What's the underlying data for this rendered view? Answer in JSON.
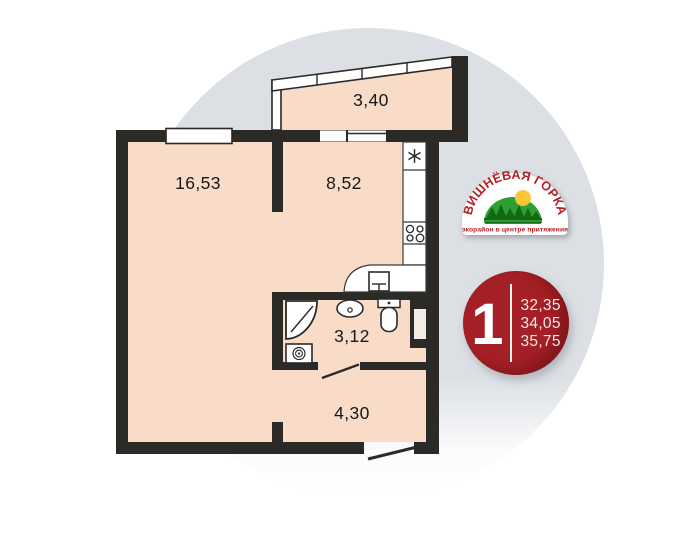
{
  "plan": {
    "rooms": [
      {
        "name": "balcony",
        "area": "3,40"
      },
      {
        "name": "living-room",
        "area": "16,53"
      },
      {
        "name": "kitchen",
        "area": "8,52"
      },
      {
        "name": "bathroom",
        "area": "3,12"
      },
      {
        "name": "hallway",
        "area": "4,30"
      }
    ],
    "fixtures": [
      "fridge-icon",
      "stove-icon",
      "kitchen-sink-icon",
      "shower-icon",
      "washing-machine-icon",
      "bathroom-sink-icon",
      "toilet-icon",
      "vent-shaft",
      "bathroom-door-swing",
      "entrance-door-swing"
    ]
  },
  "logo": {
    "title": "ВИШНЁВАЯ ГОРКА",
    "tagline": "экорайон в центре притяжения"
  },
  "badge": {
    "rooms_count": "1",
    "areas": [
      "32,35",
      "34,05",
      "35,75"
    ]
  },
  "colors": {
    "wall": "#2b2a27",
    "room_fill": "#f9dcc8",
    "background_circle": "#dce0e4",
    "badge_red": "#a42026",
    "logo_red": "#b51f24",
    "logo_green": "#2f9e33",
    "logo_dark_green": "#136813",
    "sun_yellow": "#f9c733"
  }
}
